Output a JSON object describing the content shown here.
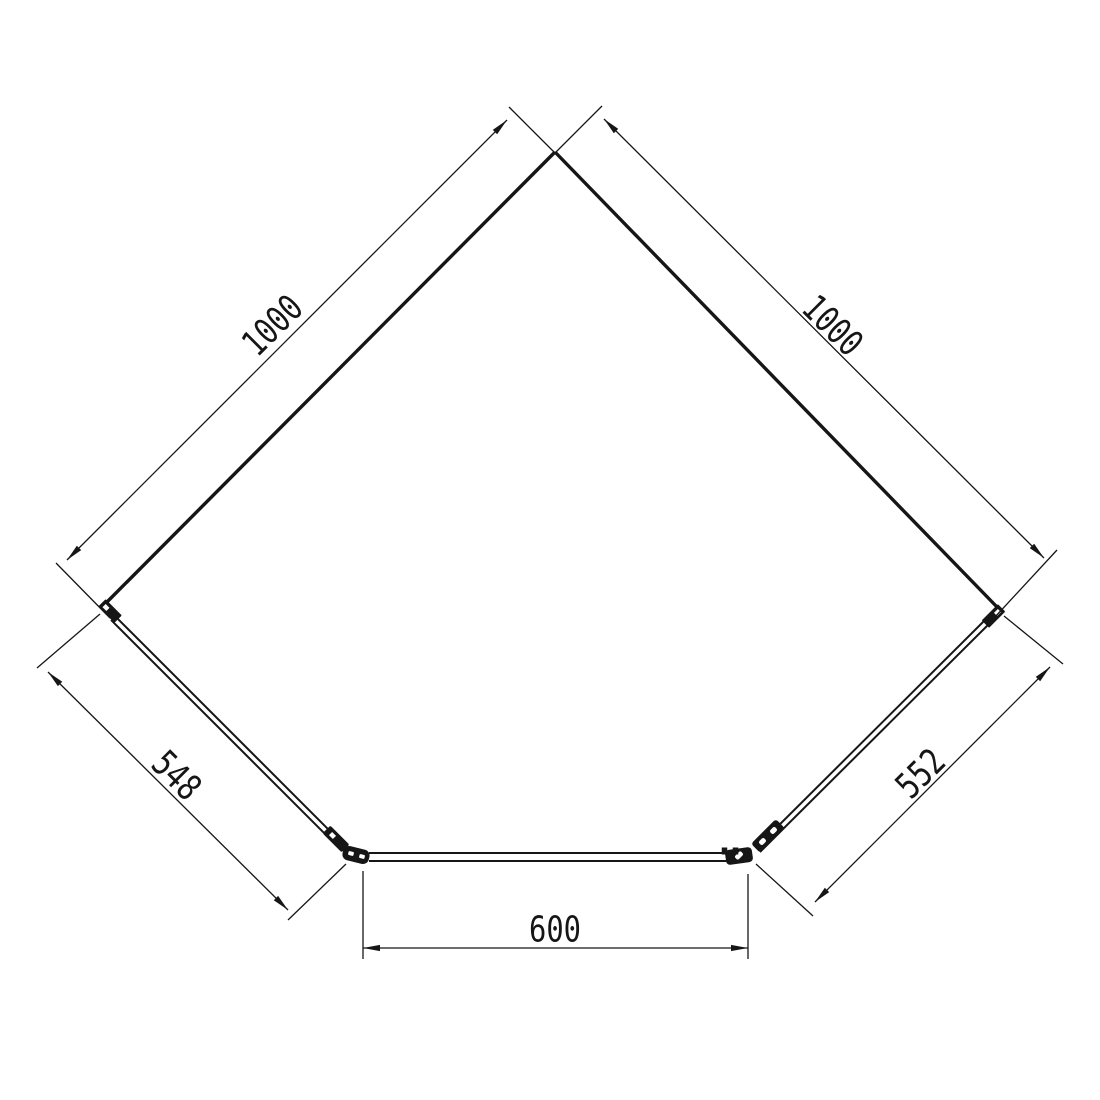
{
  "drawing": {
    "description": "pentagon-corner-shower-enclosure-plan",
    "unit": "mm",
    "measurements_shown": [
      1000,
      1000,
      548,
      552,
      600
    ],
    "canvas": {
      "width": 1100,
      "height": 1100,
      "background": "#ffffff",
      "line_color": "#161616"
    },
    "style": {
      "wall_width": 3.4,
      "panel_width": 2,
      "thin_width": 1.3,
      "dim_font_size": 36,
      "arrow_len": 17,
      "arrow_half_w": 3.1
    },
    "shape": {
      "apex": [
        555,
        152
      ],
      "left_corner": [
        104,
        605
      ],
      "right_corner": [
        999,
        609
      ],
      "bottom_left": [
        356,
        856
      ],
      "bottom_right": [
        746,
        857
      ],
      "walls": [
        {
          "name": "left-wall-line",
          "from": [
            555,
            152
          ],
          "to": [
            106,
            603
          ]
        },
        {
          "name": "right-wall-line",
          "from": [
            555,
            152
          ],
          "to": [
            997,
            607
          ]
        }
      ],
      "panels": [
        {
          "name": "left-glass-panel",
          "from": [
            113,
            618
          ],
          "to": [
            344,
            849
          ],
          "gap": 5.6
        },
        {
          "name": "right-glass-panel",
          "from": [
            987,
            622
          ],
          "to": [
            758,
            850
          ],
          "gap": 5.6
        },
        {
          "name": "door-glass-panel",
          "from": [
            369,
            857
          ],
          "to": [
            736,
            857
          ],
          "gap": 8
        }
      ],
      "fittings": [
        {
          "name": "left-wall-bracket",
          "cx": 110,
          "cy": 611,
          "w": 23,
          "h": 10.5,
          "rot": 45,
          "rx": 1,
          "fill": "line"
        },
        {
          "name": "left-wall-bracket-notch",
          "cx": 106,
          "cy": 607.5,
          "w": 5.5,
          "h": 4.5,
          "rot": 45,
          "rx": 0,
          "fill": "bg"
        },
        {
          "name": "right-wall-bracket",
          "cx": 993.5,
          "cy": 616,
          "w": 23,
          "h": 10.5,
          "rot": -45,
          "rx": 1,
          "fill": "line"
        },
        {
          "name": "right-wall-bracket-notch",
          "cx": 997.5,
          "cy": 612.5,
          "w": 5.5,
          "h": 4.5,
          "rot": -45,
          "rx": 0,
          "fill": "bg"
        },
        {
          "name": "left-panel-clamp",
          "cx": 336,
          "cy": 839,
          "w": 27,
          "h": 11,
          "rot": 45,
          "rx": 2,
          "fill": "line"
        },
        {
          "name": "left-panel-clamp-notch",
          "cx": 332.5,
          "cy": 835.5,
          "w": 5.5,
          "h": 4.5,
          "rot": 45,
          "rx": 0,
          "fill": "bg"
        },
        {
          "name": "left-door-hinge-body",
          "cx": 356,
          "cy": 855,
          "w": 27,
          "h": 14.5,
          "rot": 14,
          "rx": 6,
          "fill": "line"
        },
        {
          "name": "left-door-hinge-hole-1",
          "cx": 351,
          "cy": 853.5,
          "w": 5.5,
          "h": 4,
          "rot": 14,
          "rx": 1,
          "fill": "bg"
        },
        {
          "name": "left-door-hinge-hole-2",
          "cx": 362,
          "cy": 856.5,
          "w": 5.5,
          "h": 4,
          "rot": 14,
          "rx": 1,
          "fill": "bg"
        },
        {
          "name": "right-panel-clamp",
          "cx": 768,
          "cy": 836,
          "w": 35,
          "h": 13,
          "rot": -45,
          "rx": 3,
          "fill": "line"
        },
        {
          "name": "right-panel-clamp-hole-1",
          "cx": 762.5,
          "cy": 841.5,
          "w": 7,
          "h": 5,
          "rot": -45,
          "rx": 2,
          "fill": "bg"
        },
        {
          "name": "right-panel-clamp-hole-2",
          "cx": 773.5,
          "cy": 830.5,
          "w": 7,
          "h": 5,
          "rot": -45,
          "rx": 2,
          "fill": "bg"
        },
        {
          "name": "right-door-hinge-body",
          "cx": 739,
          "cy": 856,
          "w": 27,
          "h": 15,
          "rot": -8,
          "rx": 4,
          "fill": "line"
        },
        {
          "name": "right-door-hinge-hole",
          "cx": 739,
          "cy": 855.5,
          "w": 8.5,
          "h": 5,
          "rot": -45,
          "rx": 2,
          "fill": "bg"
        },
        {
          "name": "right-door-stop-tick-1",
          "cx": 724.5,
          "cy": 851,
          "w": 5.5,
          "h": 7,
          "rot": 0,
          "rx": 0,
          "fill": "line"
        },
        {
          "name": "right-door-stop-tick-2",
          "cx": 735.5,
          "cy": 851,
          "w": 5.5,
          "h": 7,
          "rot": 0,
          "rx": 0,
          "fill": "line"
        }
      ]
    },
    "dimensions": [
      {
        "label": "1000",
        "value_mm": 1000,
        "side": "left-wall",
        "from": [
          507,
          120
        ],
        "to": [
          67,
          560
        ],
        "text_pos": [
          273,
          326
        ],
        "text_rotation": -45,
        "text_length": 68,
        "extensions": [
          [
            563,
            161,
            509,
            107
          ],
          [
            110,
            618,
            56,
            563
          ]
        ]
      },
      {
        "label": "1000",
        "value_mm": 1000,
        "side": "right-wall",
        "from": [
          604,
          119
        ],
        "to": [
          1044,
          558
        ],
        "text_pos": [
          832,
          326
        ],
        "text_rotation": 45,
        "text_length": 68,
        "extensions": [
          [
            547,
            161,
            602,
            106
          ],
          [
            995,
            617,
            1057,
            550
          ]
        ]
      },
      {
        "label": "548",
        "value_mm": 548,
        "side": "left-panel",
        "from": [
          48,
          672
        ],
        "to": [
          288,
          910
        ],
        "text_pos": [
          176,
          776
        ],
        "text_rotation": 45,
        "text_length": 52,
        "extensions": [
          [
            100,
            614,
            37,
            668
          ],
          [
            346,
            864,
            288,
            920
          ]
        ]
      },
      {
        "label": "552",
        "value_mm": 552,
        "side": "right-panel",
        "from": [
          1050,
          667
        ],
        "to": [
          815,
          902
        ],
        "text_pos": [
          921,
          774
        ],
        "text_rotation": -45,
        "text_length": 52,
        "extensions": [
          [
            1004,
            616,
            1063,
            664
          ],
          [
            756,
            864,
            813,
            916
          ]
        ]
      },
      {
        "label": "600",
        "value_mm": 600,
        "side": "door",
        "from": [
          363,
          948
        ],
        "to": [
          748,
          948
        ],
        "text_pos": [
          555,
          930
        ],
        "text_rotation": 0,
        "text_length": 52,
        "extensions": [
          [
            363,
            871,
            363,
            959
          ],
          [
            748,
            874,
            748,
            959
          ]
        ]
      }
    ]
  }
}
